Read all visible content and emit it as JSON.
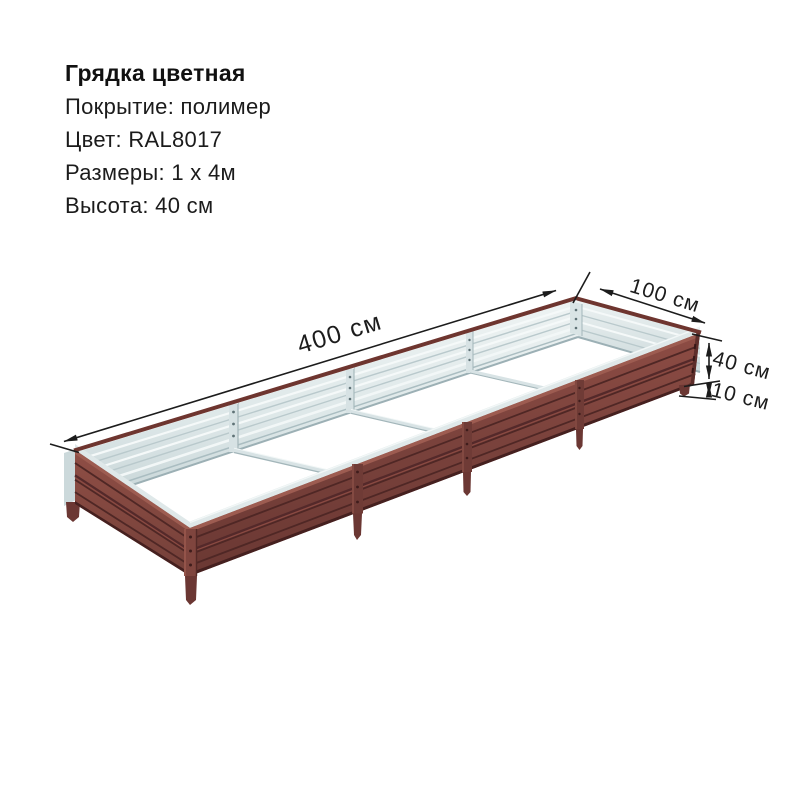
{
  "product_info": {
    "title": "Грядка цветная",
    "lines": [
      "Покрытие: полимер",
      "Цвет: RAL8017",
      "Размеры: 1 х 4м",
      "Высота: 40 см"
    ]
  },
  "dimension_labels": {
    "length": "400 см",
    "width": "100 см",
    "height": "40 см",
    "clearance": "10 см"
  },
  "colors": {
    "bed_brown": "#7c423b",
    "bed_brown_dark": "#4f2725",
    "bed_rim": "#6e352f",
    "galvanized_light": "#e9f0f0",
    "galvanized_shade": "#c9d7d9",
    "dimension_ink": "#1c1c1c",
    "background": "#ffffff"
  }
}
